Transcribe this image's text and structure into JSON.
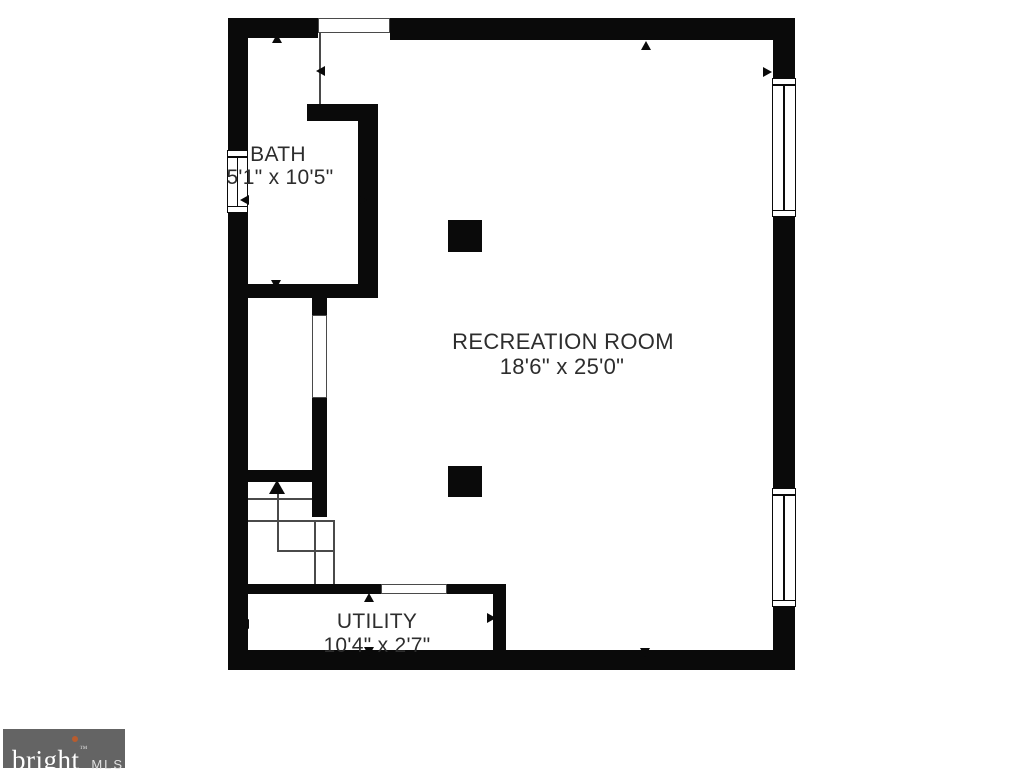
{
  "page": {
    "width": 1024,
    "height": 768,
    "background": "#ffffff"
  },
  "floor_plan": {
    "wall_color": "#0a0a0a",
    "line_color": "#4a4a4a",
    "text_color": "#2d2d2d",
    "rooms": [
      {
        "id": "bath",
        "label": "BATH",
        "dimensions": "5'1\" x 10'5\"",
        "label_cx": 278,
        "label_cy": 155,
        "dims_cx": 280,
        "dims_cy": 178,
        "font_size": 21
      },
      {
        "id": "recreation-room",
        "label": "RECREATION ROOM",
        "dimensions": "18'6\" x 25'0\"",
        "label_cx": 563,
        "label_cy": 342,
        "dims_cx": 562,
        "dims_cy": 367,
        "font_size": 22
      },
      {
        "id": "utility",
        "label": "UTILITY",
        "dimensions": "10'4\" x 2'7\"",
        "label_cx": 377,
        "label_cy": 622,
        "dims_cx": 377,
        "dims_cy": 646,
        "font_size": 21
      }
    ],
    "walls": [
      {
        "name": "top-wall-left",
        "x": 228,
        "y": 18,
        "w": 90,
        "h": 20
      },
      {
        "name": "top-wall-right",
        "x": 390,
        "y": 18,
        "w": 405,
        "h": 22
      },
      {
        "name": "left-wall-upper",
        "x": 228,
        "y": 18,
        "w": 20,
        "h": 132
      },
      {
        "name": "left-wall-lower",
        "x": 228,
        "y": 213,
        "w": 20,
        "h": 457
      },
      {
        "name": "right-wall-upper",
        "x": 773,
        "y": 18,
        "w": 22,
        "h": 60
      },
      {
        "name": "right-wall-middle",
        "x": 773,
        "y": 217,
        "w": 22,
        "h": 271
      },
      {
        "name": "right-wall-lower",
        "x": 773,
        "y": 607,
        "w": 22,
        "h": 63
      },
      {
        "name": "bottom-wall",
        "x": 228,
        "y": 650,
        "w": 567,
        "h": 20
      },
      {
        "name": "bath-north-inner-wall",
        "x": 307,
        "y": 104,
        "w": 71,
        "h": 17
      },
      {
        "name": "bath-east-inner-wall",
        "x": 358,
        "y": 104,
        "w": 20,
        "h": 194
      },
      {
        "name": "bath-south-wall",
        "x": 228,
        "y": 284,
        "w": 150,
        "h": 14
      },
      {
        "name": "hall-east-wall-stub",
        "x": 312,
        "y": 298,
        "w": 15,
        "h": 17
      },
      {
        "name": "hall-east-wall",
        "x": 312,
        "y": 398,
        "w": 15,
        "h": 119
      },
      {
        "name": "stairs-north-wall",
        "x": 228,
        "y": 470,
        "w": 84,
        "h": 12
      },
      {
        "name": "utility-north-wall-left",
        "x": 228,
        "y": 584,
        "w": 153,
        "h": 10
      },
      {
        "name": "utility-north-wall-right",
        "x": 447,
        "y": 584,
        "w": 59,
        "h": 10
      },
      {
        "name": "utility-east-wall",
        "x": 493,
        "y": 594,
        "w": 13,
        "h": 56
      }
    ],
    "openings": [
      {
        "name": "entry-opening",
        "x": 318,
        "y": 18,
        "w": 72,
        "h": 15
      },
      {
        "name": "hall-doorway",
        "x": 312,
        "y": 315,
        "w": 15,
        "h": 83
      },
      {
        "name": "utility-doorway",
        "x": 381,
        "y": 584,
        "w": 66,
        "h": 10
      }
    ],
    "windows": [
      {
        "name": "bath-window",
        "x": 227,
        "y": 150,
        "w": 21,
        "h": 63
      },
      {
        "name": "rec-window-upper",
        "x": 772,
        "y": 78,
        "w": 24,
        "h": 139
      },
      {
        "name": "rec-window-lower",
        "x": 772,
        "y": 488,
        "w": 24,
        "h": 119
      }
    ],
    "columns": [
      {
        "name": "column-upper",
        "x": 448,
        "y": 220,
        "w": 34,
        "h": 32
      },
      {
        "name": "column-lower",
        "x": 448,
        "y": 466,
        "w": 34,
        "h": 31
      }
    ],
    "lines": [
      {
        "name": "entry-jamb-line",
        "x": 319,
        "y": 33,
        "len": 71,
        "dir": "v"
      },
      {
        "name": "stair-tread-1",
        "x": 248,
        "y": 498,
        "len": 64,
        "dir": "h"
      },
      {
        "name": "stair-tread-2",
        "x": 248,
        "y": 520,
        "len": 85,
        "dir": "h"
      },
      {
        "name": "stair-rail-left",
        "x": 314,
        "y": 520,
        "len": 64,
        "dir": "v"
      },
      {
        "name": "stair-rail-right",
        "x": 333,
        "y": 520,
        "len": 64,
        "dir": "v"
      },
      {
        "name": "stair-turn-line",
        "x": 277,
        "y": 550,
        "len": 56,
        "dir": "h"
      },
      {
        "name": "stair-direction-line",
        "x": 277,
        "y": 492,
        "len": 58,
        "dir": "v"
      }
    ],
    "dimension_arrows": [
      {
        "name": "rec-width-arrow-left",
        "x": 316,
        "y": 71,
        "dir": "left",
        "size": "small"
      },
      {
        "name": "rec-width-arrow-right",
        "x": 772,
        "y": 72,
        "dir": "right",
        "size": "small"
      },
      {
        "name": "rec-length-arrow-top",
        "x": 646,
        "y": 41,
        "dir": "up",
        "size": "small"
      },
      {
        "name": "rec-length-arrow-bottom",
        "x": 645,
        "y": 657,
        "dir": "down",
        "size": "small"
      },
      {
        "name": "bath-width-arrow-left",
        "x": 240,
        "y": 200,
        "dir": "left",
        "size": "small"
      },
      {
        "name": "bath-width-arrow-right",
        "x": 367,
        "y": 200,
        "dir": "right",
        "size": "small"
      },
      {
        "name": "bath-length-arrow-top",
        "x": 277,
        "y": 34,
        "dir": "up",
        "size": "small"
      },
      {
        "name": "bath-length-arrow-bottom",
        "x": 276,
        "y": 289,
        "dir": "down",
        "size": "small"
      },
      {
        "name": "utility-width-arrow-left",
        "x": 240,
        "y": 624,
        "dir": "left",
        "size": "small"
      },
      {
        "name": "utility-width-arrow-right",
        "x": 496,
        "y": 618,
        "dir": "right",
        "size": "small"
      },
      {
        "name": "utility-height-arrow-top",
        "x": 369,
        "y": 593,
        "dir": "up",
        "size": "small"
      },
      {
        "name": "utility-height-arrow-bottom",
        "x": 369,
        "y": 656,
        "dir": "down",
        "size": "small"
      },
      {
        "name": "stairs-up-arrow",
        "x": 277,
        "y": 480,
        "dir": "up",
        "size": "large"
      }
    ]
  },
  "branding": {
    "logo_text": "bright",
    "logo_tm": "™",
    "logo_suffix": "MLS",
    "bg": "#646464",
    "text_color": "#ffffff",
    "dot_color": "#b85c2e"
  }
}
